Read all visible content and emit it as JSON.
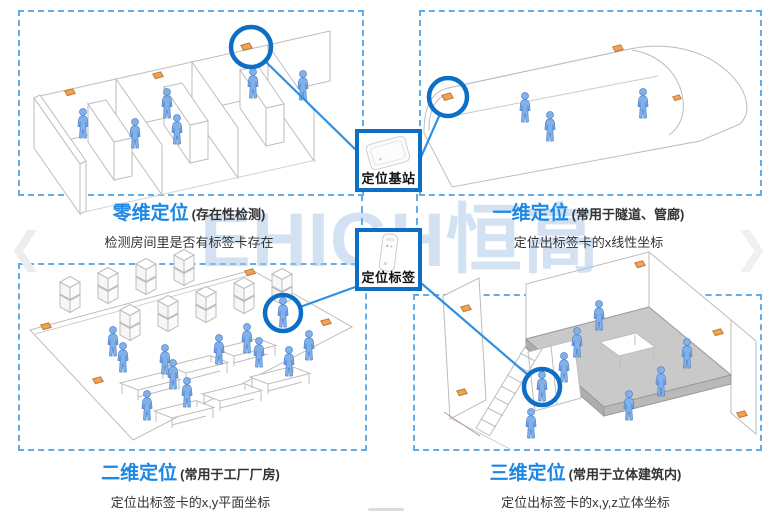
{
  "watermark": "EHIGH恒高",
  "nav": {
    "prev_icon": "❮",
    "next_icon": "❯"
  },
  "center": {
    "base_station": {
      "label": "定位基站"
    },
    "tag": {
      "label": "定位标签"
    }
  },
  "quadrants": [
    {
      "title": "零维定位",
      "qualifier": "(存在性检测)",
      "description": "检测房间里是否有标签卡存在"
    },
    {
      "title": "一维定位",
      "qualifier": "(常用于隧道、管廊)",
      "description": "定位出标签卡的x线性坐标"
    },
    {
      "title": "二维定位",
      "qualifier": "(常用于工厂厂房)",
      "description": "定位出标签卡的x,y平面坐标"
    },
    {
      "title": "三维定位",
      "qualifier": "(常用于立体建筑内)",
      "description": "定位出标签卡的x,y,z立体坐标"
    }
  ],
  "colors": {
    "accent_blue": "#1d87e4",
    "highlight_blue": "#0d6ec6",
    "connector_blue": "#2f90e2",
    "dashed_border": "#62acea",
    "anchor_orange": "#f2a254",
    "person_blue": "#82b1ea",
    "platform_gray": "#c9c9c9",
    "watermark_blue": "#a6c6e8"
  }
}
